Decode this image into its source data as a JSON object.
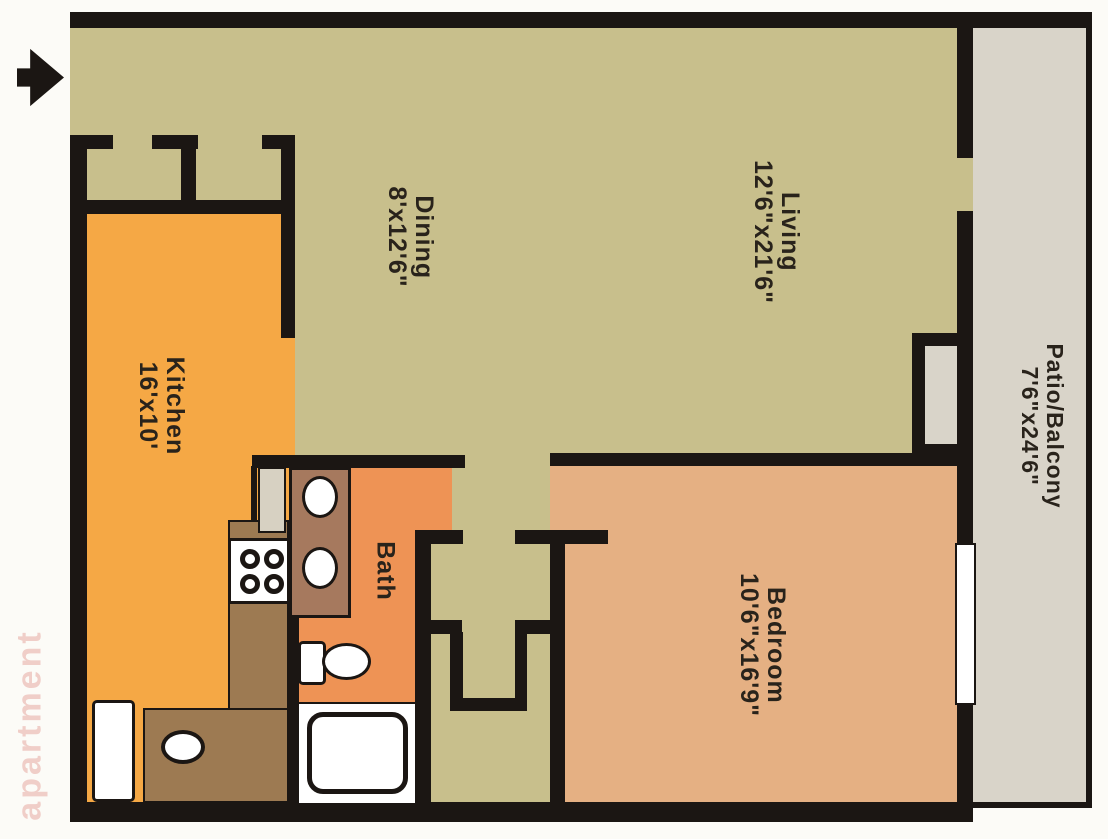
{
  "plan": {
    "type": "apartment-floor-plan",
    "watermark": "apartment",
    "entry_arrow": "right-arrow-icon",
    "rooms": {
      "dining": {
        "name": "Dining",
        "dims": "8'x12'6\""
      },
      "living": {
        "name": "Living",
        "dims": "12'6\"x21'6\""
      },
      "kitchen": {
        "name": "Kitchen",
        "dims": "16'x10'"
      },
      "bath": {
        "name": "Bath",
        "dims": ""
      },
      "bedroom": {
        "name": "Bedroom",
        "dims": "10'6\"x16'9\""
      },
      "patio": {
        "name": "Patio/Balcony",
        "dims": "7'6\"x24'6\""
      }
    },
    "fixtures": [
      "entry-closets",
      "kitchen-counter",
      "stove-4-burners",
      "kitchen-sink",
      "refrigerator",
      "bath-vanity-double-sink",
      "toilet",
      "bathtub",
      "linen-closet",
      "patio-storage-closet",
      "bedroom-window",
      "sliding-door-to-patio"
    ],
    "colors": {
      "living_dining": "#c8bf8c",
      "kitchen": "#f5a845",
      "bath": "#ee9355",
      "bedroom": "#e5b083",
      "patio": "#d9d4c9",
      "counter": "#9d7a52",
      "vanity": "#a6795e",
      "appliance": "#d7d1c2",
      "wall": "#1b1613",
      "label_text": "#29231b",
      "watermark_red": "#d66a60"
    }
  }
}
